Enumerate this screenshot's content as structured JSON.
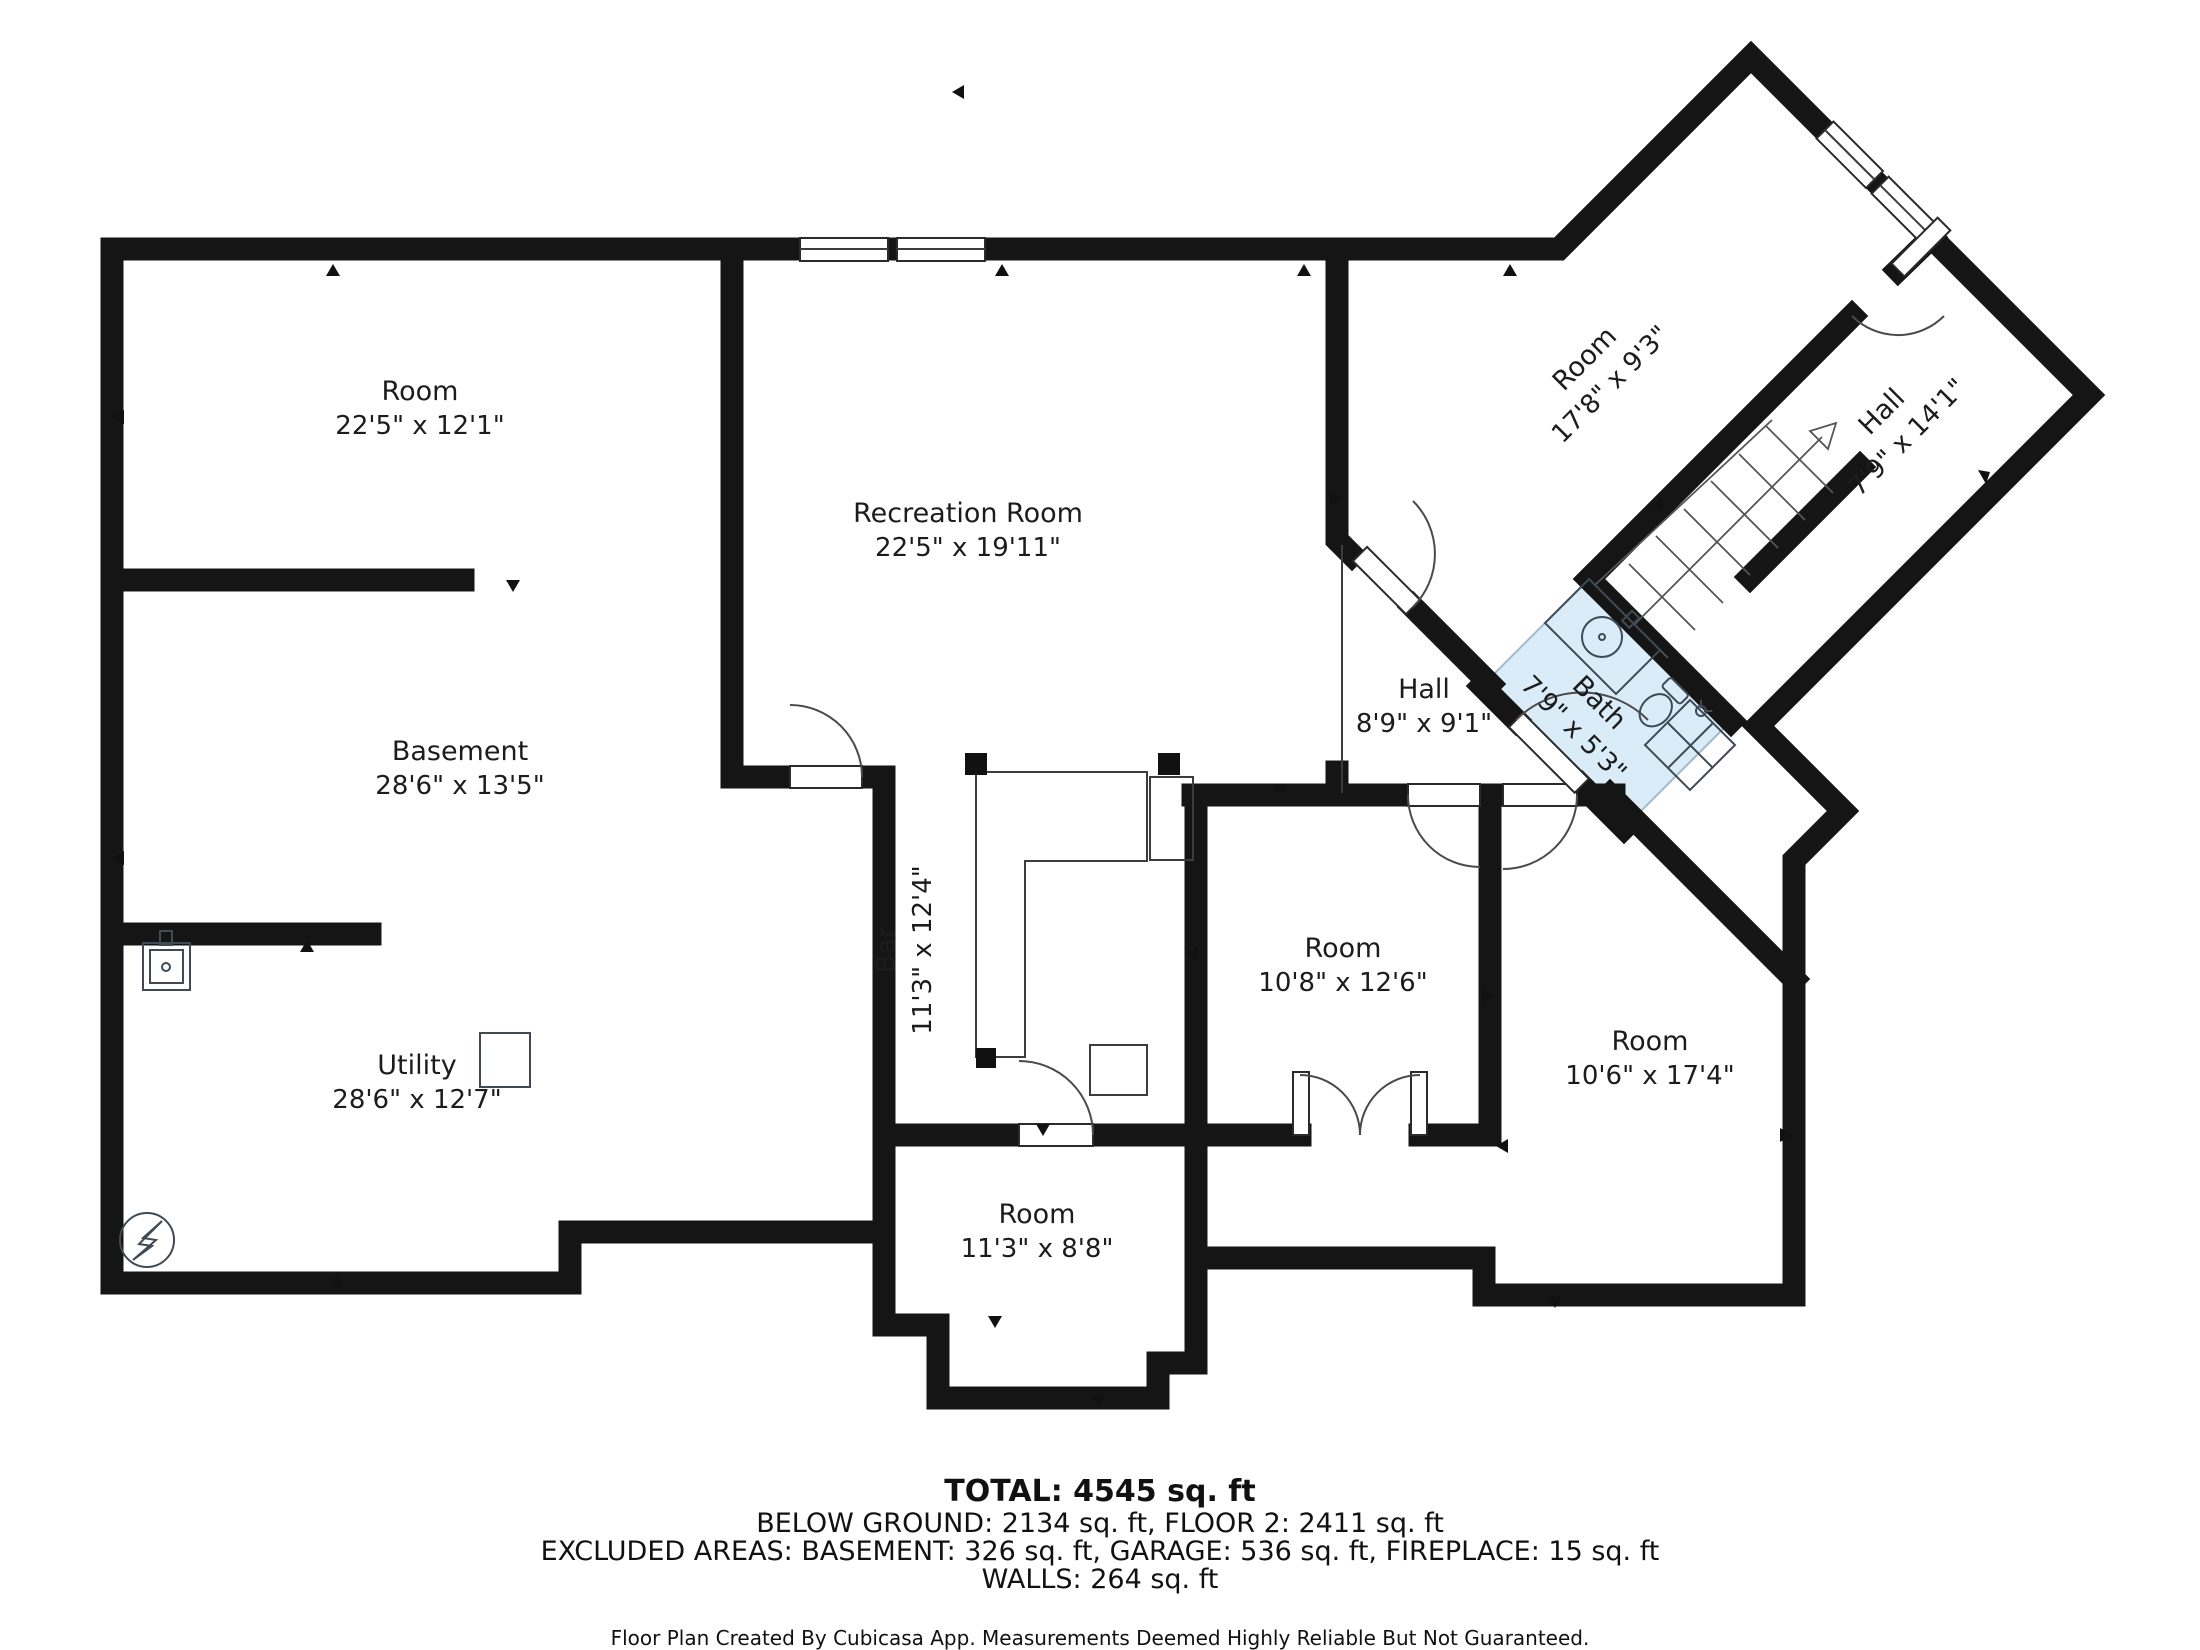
{
  "title": "Basement floor plan",
  "colors": {
    "wall": "#151515",
    "bath_fill": "#d9ecf8",
    "bath_stroke": "#9fb9cb"
  },
  "rooms": [
    {
      "name": "Room",
      "dims": "22'5\" x 12'1\""
    },
    {
      "name": "Recreation Room",
      "dims": "22'5\" x 19'11\""
    },
    {
      "name": "Basement",
      "dims": "28'6\" x 13'5\""
    },
    {
      "name": "Utility",
      "dims": "28'6\" x 12'7\""
    },
    {
      "name": "Bar",
      "dims": "11'3\" x 12'4\""
    },
    {
      "name": "Room",
      "dims": "11'3\" x 8'8\""
    },
    {
      "name": "Room",
      "dims": "10'8\" x 12'6\""
    },
    {
      "name": "Room",
      "dims": "10'6\" x 17'4\""
    },
    {
      "name": "Hall",
      "dims": "8'9\" x 9'1\""
    },
    {
      "name": "Bath",
      "dims": "7'9\" x 5'3\""
    },
    {
      "name": "Room",
      "dims": "17'8\" x 9'3\""
    },
    {
      "name": "Hall",
      "dims": "7'9\" x 14'1\""
    }
  ],
  "summary": {
    "total": "TOTAL: 4545 sq. ft",
    "below_ground": "BELOW GROUND: 2134 sq. ft, FLOOR 2: 2411 sq. ft",
    "excluded": "EXCLUDED AREAS: BASEMENT: 326 sq. ft, GARAGE: 536 sq. ft, FIREPLACE: 15 sq. ft",
    "walls": "WALLS: 264 sq. ft"
  },
  "disclaimer": "Floor Plan Created By Cubicasa App. Measurements Deemed Highly Reliable But Not Guaranteed."
}
